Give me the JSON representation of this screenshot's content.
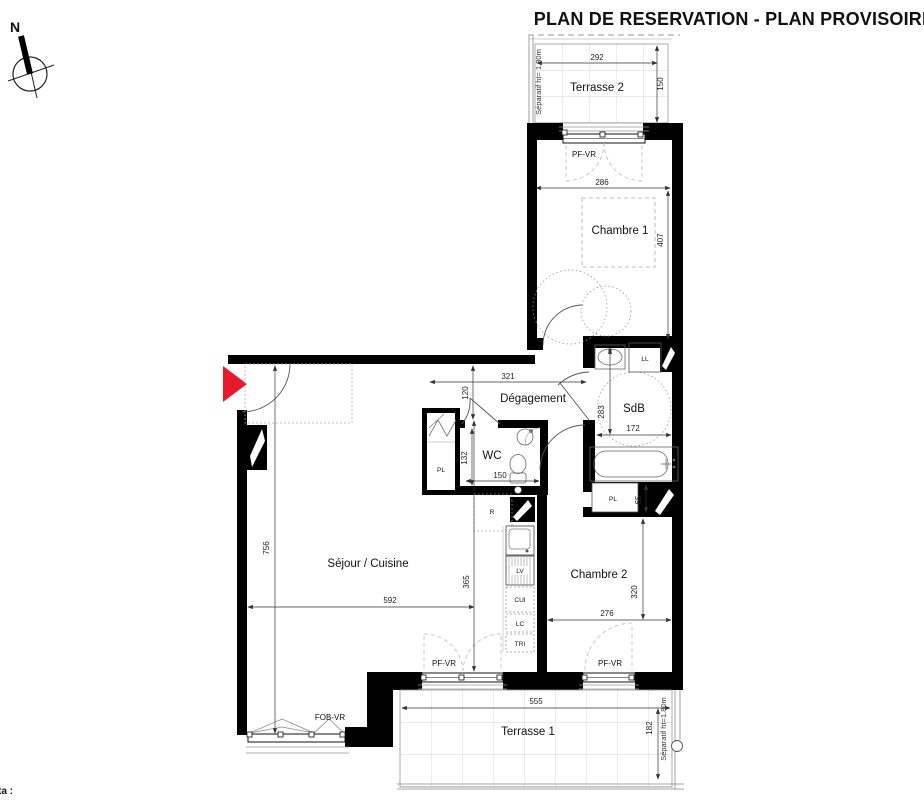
{
  "title": "PLAN DE RESERVATION - PLAN PROVISOIRE",
  "compass": {
    "north_label": "N"
  },
  "rooms": {
    "terrasse2": "Terrasse 2",
    "chambre1": "Chambre 1",
    "degagement": "Dégagement",
    "sdb": "SdB",
    "wc": "WC",
    "sejour_cuisine": "Séjour / Cuisine",
    "chambre2": "Chambre 2",
    "terrasse1": "Terrasse 1"
  },
  "fixtures": {
    "ll": "LL",
    "pl": "PL",
    "r": "R",
    "lv": "LV",
    "cui": "CUI",
    "lc": "LC",
    "tri": "TRI"
  },
  "openings": {
    "pf_vr": "PF-VR",
    "fob_vr": "FOB-VR"
  },
  "separators": {
    "terrasse2": "Séparatif ht= 1.80m",
    "terrasse1": "Séparatif ht=1.80m"
  },
  "dimensions": {
    "terrasse2_width": "292",
    "terrasse2_depth": "150",
    "chambre1_width": "286",
    "chambre1_length": "407",
    "degagement_width": "321",
    "degagement_depth": "120",
    "sdb_length": "283",
    "sdb_width": "172",
    "wc_length": "132",
    "wc_width": "150",
    "sejour_length": "756",
    "sejour_width": "592",
    "sejour_right_length": "365",
    "chambre2_length": "320",
    "chambre2_width": "276",
    "pl_depth": "65",
    "terrasse1_width": "555",
    "terrasse1_depth": "182"
  },
  "footer": {
    "note_partial": "ta :"
  },
  "colors": {
    "wall": "#000000",
    "entrance_arrow": "#e8192c"
  }
}
